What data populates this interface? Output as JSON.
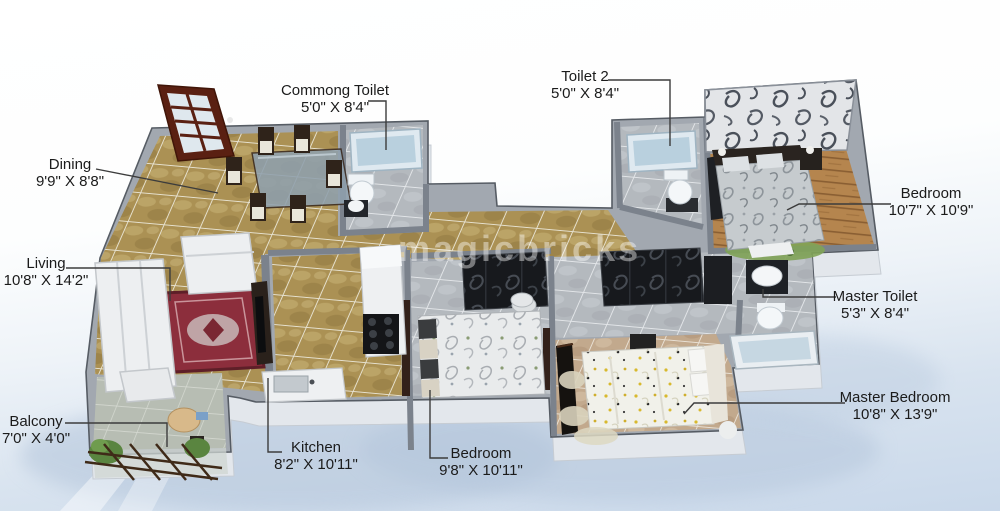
{
  "watermark": "magicbricks",
  "labels": [
    {
      "id": "dining",
      "name": "Dining",
      "dims": "9'9\" X 8'8\""
    },
    {
      "id": "commong-toilet",
      "name": "Commong Toilet",
      "dims": "5'0\" X 8'4\""
    },
    {
      "id": "toilet-2",
      "name": "Toilet 2",
      "dims": "5'0\" X 8'4\""
    },
    {
      "id": "bedroom-right",
      "name": "Bedroom",
      "dims": "10'7\" X 10'9\""
    },
    {
      "id": "living",
      "name": "Living",
      "dims": "10'8\" X 14'2\""
    },
    {
      "id": "master-toilet",
      "name": "Master Toilet",
      "dims": "5'3\" X 8'4\""
    },
    {
      "id": "master-bedroom",
      "name": "Master Bedroom",
      "dims": "10'8\" X 13'9\""
    },
    {
      "id": "balcony",
      "name": "Balcony",
      "dims": "7'0\" X 4'0\""
    },
    {
      "id": "kitchen",
      "name": "Kitchen",
      "dims": "8'2\" X 10'11\""
    },
    {
      "id": "bedroom-center",
      "name": "Bedroom",
      "dims": "9'8\" X 10'11\""
    }
  ],
  "colors": {
    "label_text": "#1b1b1b",
    "leader_line": "#3c3c3c",
    "wall_gray": "#a2a8b0",
    "wall_face": "#e2e6ea",
    "floor_tan": "#ab9154",
    "floor_gray_tile": "#b4b9be",
    "floor_wood": "#b5854e",
    "rug_red": "#8c2e3c",
    "tub_blue": "#c6d7e2",
    "door_brown": "#5a2012",
    "ground_blue": "#c9d8ea"
  }
}
